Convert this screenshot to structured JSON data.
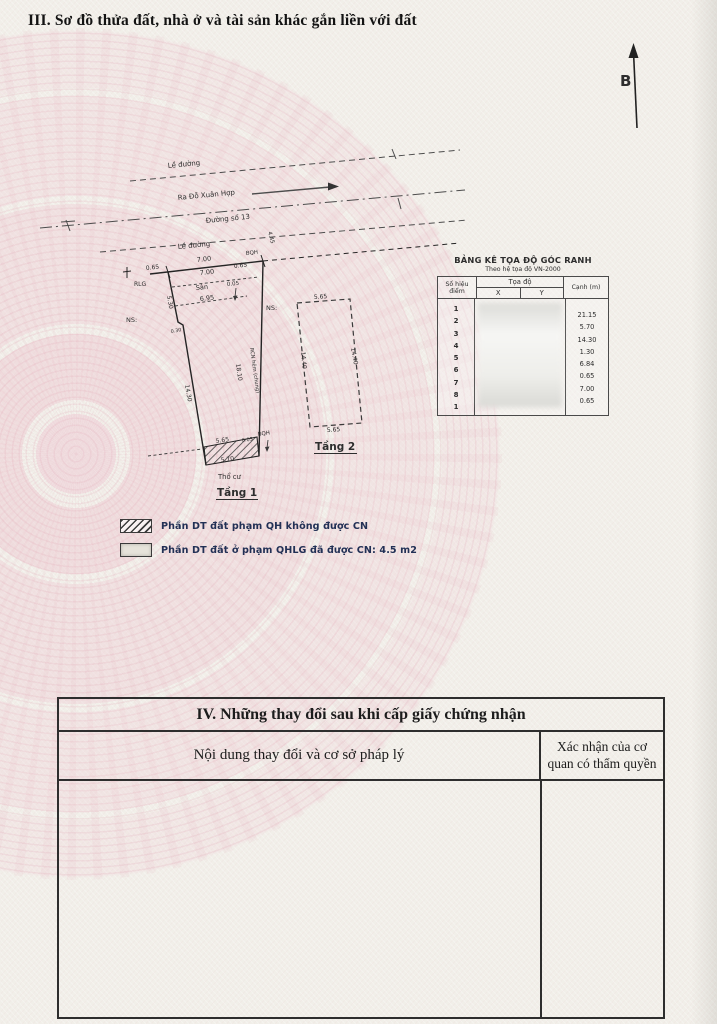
{
  "header": {
    "section_title": "III. Sơ đồ thửa đất, nhà ở và tài sản khác gắn liền với đất",
    "north_label": "B"
  },
  "diagram": {
    "streets": {
      "sidewalk_top": "Lề đường",
      "direction_label": "Ra Đỗ Xuân Hợp",
      "street_name": "Đường số 13",
      "sidewalk_bottom": "Lề đường",
      "offset_445": "4.45"
    },
    "floor1": {
      "label": "Tầng 1",
      "land_type": "Thổ cư",
      "yard": "Sân",
      "dim_frontage": "7.00",
      "dim_frontage_inner": "7.00",
      "dim_offset_left": "0.65",
      "dim_offset_right": "0.65",
      "dim_gap_top": "0.05",
      "dim_inner_width": "6.95",
      "dim_left_upper": "5.30",
      "dim_left_jog": "0.30",
      "dim_left_lower": "14.30",
      "dim_right": "18.10",
      "right_note": "RCN hẻm (chung)",
      "mark_rlg": "RLG",
      "mark_bqh_top": "BQH",
      "mark_bqh_bottom": "BQH",
      "mark_ns_left": "NS:",
      "mark_ns_right": "NS:",
      "dim_hatch_top": "5.65",
      "dim_hatch_gap": "0.05",
      "dim_hatch_bottom": "5.70"
    },
    "floor2": {
      "label": "Tầng 2",
      "dim_top": "5.65",
      "dim_left": "14.40",
      "dim_right": "14.40",
      "dim_bottom": "5.65"
    }
  },
  "coord_table": {
    "title": "BẢNG KÊ TỌA ĐỘ GÓC RANH",
    "subtitle": "Theo hệ tọa độ VN-2000",
    "col_point_no": "Số hiệu điểm",
    "col_coords": "Tọa độ",
    "col_x": "X",
    "col_y": "Y",
    "col_edge": "Cạnh (m)",
    "points": [
      "1",
      "2",
      "3",
      "4",
      "5",
      "6",
      "7",
      "8",
      "1"
    ],
    "edges": [
      "21.15",
      "5.70",
      "14.30",
      "1.30",
      "6.84",
      "0.65",
      "7.00",
      "0.65"
    ]
  },
  "legend": {
    "item1_label": "Phần DT đất phạm QH không được CN",
    "item2_label": "Phần DT đất ở phạm QHLG đã được CN: 4.5 m2"
  },
  "section4": {
    "title": "IV. Những thay đổi sau khi cấp giấy chứng nhận",
    "col_content": "Nội dung thay đổi và cơ sở pháp lý",
    "col_confirm": "Xác nhận của cơ quan có thẩm quyền"
  }
}
